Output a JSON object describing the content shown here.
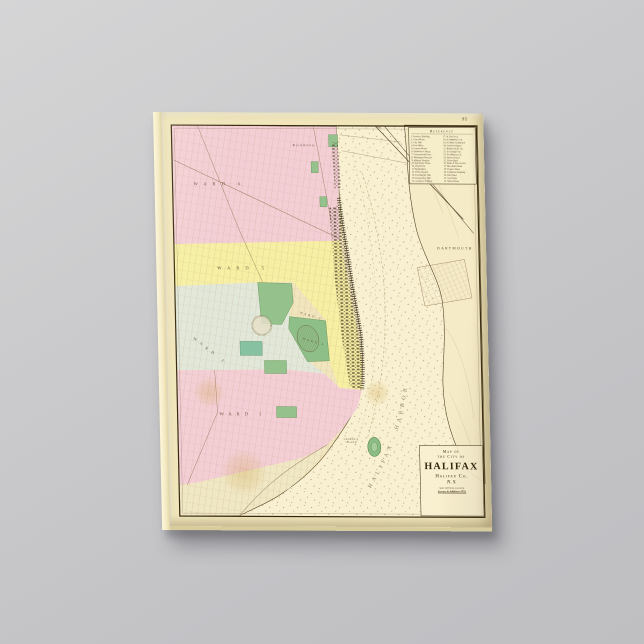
{
  "product": {
    "description": "Vintage map canvas print on grey studio background",
    "background_color": "#c8c8cb",
    "canvas_edge_color": "#f3e9c2"
  },
  "map": {
    "page_number": "95",
    "reference": {
      "title": "Reference",
      "left_column": [
        "1. Province Building",
        "2. Court House",
        "3. City Hall",
        "4. Post Office",
        "5. Custom House",
        "6. Dalhousie College",
        "7. Government House",
        "8. Wellington Barracks",
        "9. Military Hospital",
        "10. Admiralty House",
        "11. City Prison",
        "12. Penitentiary",
        "13. Poors' Asylum",
        "14. Freemasons' Hall",
        "15. Temperance Hall",
        "16. Academy of Music"
      ],
      "right_column": [
        "17. St. Paul's Ch.",
        "18. St. Matthew's Ch.",
        "19. St. Mary's Cathedral",
        "20. Garrison Chapel",
        "21. Brunswick St. Ch.",
        "22. St. George's Ch.",
        "23. Fort Massey Ch.",
        "24. Salem Chapel",
        "25. Union Bank",
        "26. Bank of Nova Scotia",
        "27. Merchants' Bank",
        "28. People's Bank",
        "29. Exhibition Building",
        "30. Drill Shed",
        "31. Gas Works",
        "32. Water Works"
      ]
    },
    "labels": {
      "richmond": "Richmond",
      "dartmouth": "DARTMOUTH",
      "harbor": "HALIFAX HARBOR",
      "georges_island_line1": "GEORGE'S",
      "georges_island_line2": "ISLAND",
      "scale_note": "1 Mile"
    },
    "wards": [
      {
        "label": "WARD 6"
      },
      {
        "label": "WARD 5"
      },
      {
        "label": "WARD 2"
      },
      {
        "label": "WARD 3"
      },
      {
        "label": "WARD 4"
      },
      {
        "label": "WARD 1"
      }
    ],
    "title_box": {
      "line1": "Map of",
      "line2": "the City of",
      "line3": "HALIFAX",
      "line4": "Halifax Co.",
      "line5": "N. S.",
      "line6": "Scale 1600 Feet to an Inch.",
      "line7": "Surveys & Additions 1878."
    },
    "colors": {
      "paper": "#f1e7c0",
      "water": "#f8f0d0",
      "ward_pink": "#f3cfd5",
      "ward_yellow": "#f6efa4",
      "ward_sage": "#e2e8d9",
      "park_green": "#95c28c",
      "line_brown": "#8a6a4a",
      "ink_dark": "#36290f"
    }
  }
}
